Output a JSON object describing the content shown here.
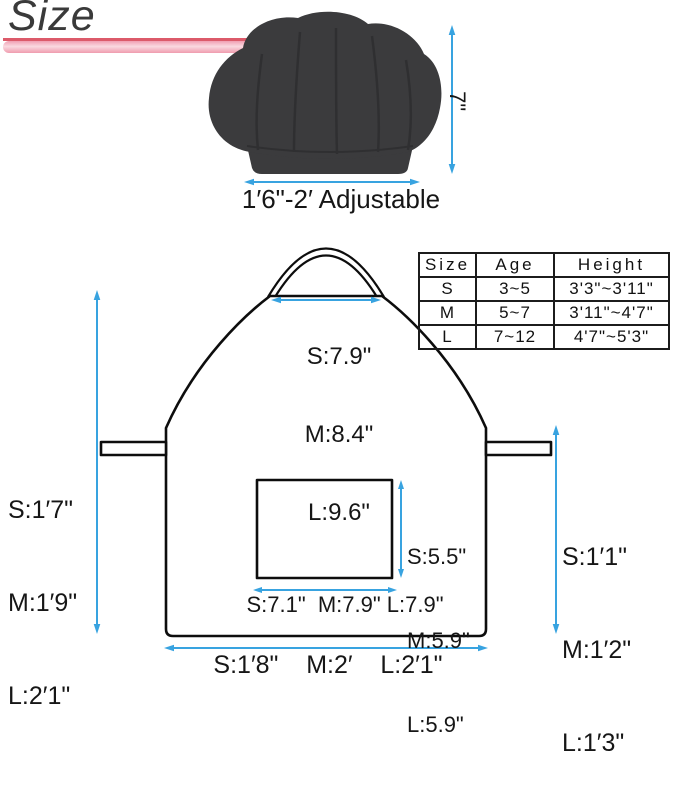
{
  "title": "Size",
  "hat": {
    "height_label": "7\"",
    "width_label": "1′6\"-2′ Adjustable"
  },
  "bib_width": {
    "s": "S:7.9\"",
    "m": "M:8.4\"",
    "l": "L:9.6\""
  },
  "apron_length": {
    "s": "S:1′7\"",
    "m": "M:1′9\"",
    "l": "L:2′1\""
  },
  "side_height": {
    "s": "S:1′1\"",
    "m": "M:1′2\"",
    "l": "L:1′3\""
  },
  "pocket_height": {
    "s": "S:5.5\"",
    "m": "M:5.9\"",
    "l": "L:5.9\""
  },
  "pocket_width": "S:7.1\"  M:7.9\" L:7.9\"",
  "bottom_width": "S:1′8\"    M:2′    L:2′1\"",
  "size_table": {
    "headers": [
      "Size",
      "Age",
      "Height"
    ],
    "rows": [
      [
        "S",
        "3~5",
        "3'3\"~3'11\""
      ],
      [
        "M",
        "5~7",
        "3'11\"~4'7\""
      ],
      [
        "L",
        "7~12",
        "4'7\"~5'3\""
      ]
    ]
  },
  "colors": {
    "accent_blue": "#38a3e0",
    "bar_pink": "#f0a0b2",
    "bar_red": "#dc5a6a",
    "hat_fill": "#3b3b3d",
    "line_black": "#0d0d0d"
  }
}
